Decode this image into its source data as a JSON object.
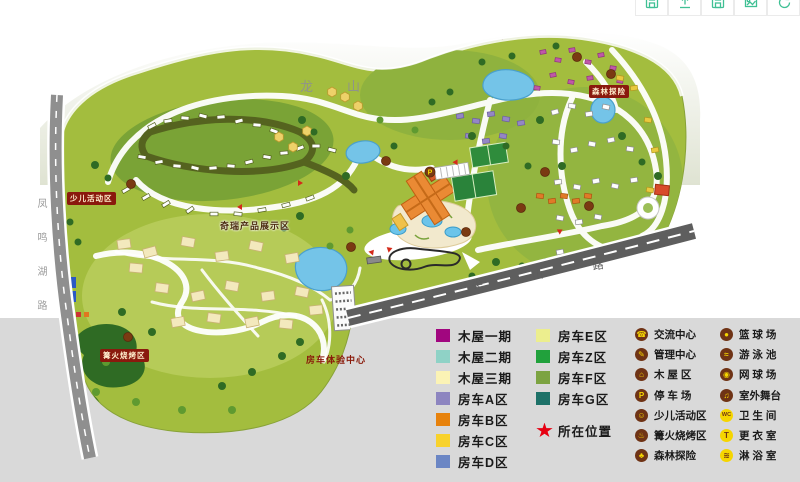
{
  "toolbar": {
    "icon_color": "#3fc094",
    "buttons": [
      {
        "name": "save-button",
        "icon": "save"
      },
      {
        "name": "upload-button",
        "icon": "upload"
      },
      {
        "name": "save-copy-button",
        "icon": "save"
      },
      {
        "name": "export-image-button",
        "icon": "image"
      },
      {
        "name": "share-button",
        "icon": "sync"
      }
    ]
  },
  "map_labels": {
    "mountain": "龙山",
    "left_road": "凤鸣湖路",
    "diagonal_road": "尖山路",
    "children_area": "少儿活动区",
    "chery_exhibit": "奇瑞产品展示区",
    "bonfire_area": "篝火烧烤区",
    "rv_center": "房车体验中心",
    "forest_adventure": "森林探险"
  },
  "legend_colors": {
    "column1": [
      {
        "label": "木屋一期",
        "color": "#a1067f"
      },
      {
        "label": "木屋二期",
        "color": "#8fd2c6"
      },
      {
        "label": "木屋三期",
        "color": "#fbf3b5"
      },
      {
        "label": "房车A区",
        "color": "#8d85c0"
      },
      {
        "label": "房车B区",
        "color": "#e7820d"
      },
      {
        "label": "房车C区",
        "color": "#f8d22c"
      },
      {
        "label": "房车D区",
        "color": "#6b86c4"
      }
    ],
    "column2": [
      {
        "label": "房车E区",
        "color": "#ecee8e"
      },
      {
        "label": "房车Z区",
        "color": "#21a13c"
      },
      {
        "label": "房车F区",
        "color": "#7ca341"
      },
      {
        "label": "房车G区",
        "color": "#1d7168"
      }
    ],
    "location_label": "所在位置",
    "star_color": "#e60012"
  },
  "legend_icons": {
    "brown": "#6f3315",
    "yellow": "#f5d500",
    "column1": [
      {
        "label": "交流中心",
        "glyph": "☎",
        "variant": "brown",
        "name": "exchange-center"
      },
      {
        "label": "管理中心",
        "glyph": "✎",
        "variant": "brown",
        "name": "management-center"
      },
      {
        "label": "木 屋 区",
        "glyph": "⌂",
        "variant": "brown",
        "name": "wood-house-area"
      },
      {
        "label": "停 车 场",
        "glyph": "P",
        "variant": "brown",
        "name": "parking-lot"
      },
      {
        "label": "少儿活动区",
        "glyph": "☺",
        "variant": "brown",
        "name": "children-activity-area"
      },
      {
        "label": "篝火烧烤区",
        "glyph": "♨",
        "variant": "brown",
        "name": "bonfire-bbq-area"
      },
      {
        "label": "森林探险",
        "glyph": "♣",
        "variant": "brown",
        "name": "forest-adventure"
      }
    ],
    "column2": [
      {
        "label": "篮 球 场",
        "glyph": "●",
        "variant": "brown",
        "name": "basketball-court"
      },
      {
        "label": "游 泳 池",
        "glyph": "≈",
        "variant": "brown",
        "name": "swimming-pool"
      },
      {
        "label": "网 球 场",
        "glyph": "◉",
        "variant": "brown",
        "name": "tennis-court"
      },
      {
        "label": "室外舞台",
        "glyph": "♫",
        "variant": "brown",
        "name": "outdoor-stage"
      },
      {
        "label": "卫 生 间",
        "glyph": "WC",
        "variant": "yellow",
        "name": "restroom"
      },
      {
        "label": "更 衣 室",
        "glyph": "T",
        "variant": "yellow",
        "name": "changing-room"
      },
      {
        "label": "淋 浴 室",
        "glyph": "≋",
        "variant": "yellow",
        "name": "shower-room"
      }
    ]
  }
}
